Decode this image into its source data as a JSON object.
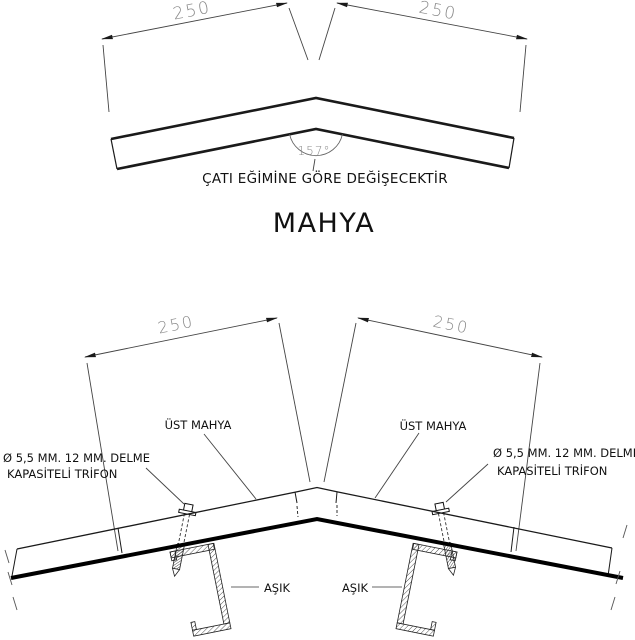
{
  "top": {
    "dim_left": "250",
    "dim_right": "250",
    "angle": "157°",
    "note": "ÇATI EĞİMİNE GÖRE DEĞİŞECEKTİR",
    "title": "MAHYA"
  },
  "bottom": {
    "dim_left": "250",
    "dim_right": "250",
    "cap_label_left": "ÜST MAHYA",
    "cap_label_right": "ÜST MAHYA",
    "screw_left_1": "Ø 5,5 MM. 12 MM. DELME",
    "screw_left_2": "KAPASİTELİ TRİFON",
    "screw_right_1": "Ø 5,5 MM. 12 MM. DELME",
    "screw_right_2": "KAPASİTELİ TRİFON",
    "purlin_label_left": "AŞIK",
    "purlin_label_right": "AŞIK"
  },
  "colors": {
    "background": "#ffffff",
    "line": "#1a1a1a",
    "dimension": "#8a8a8a"
  }
}
